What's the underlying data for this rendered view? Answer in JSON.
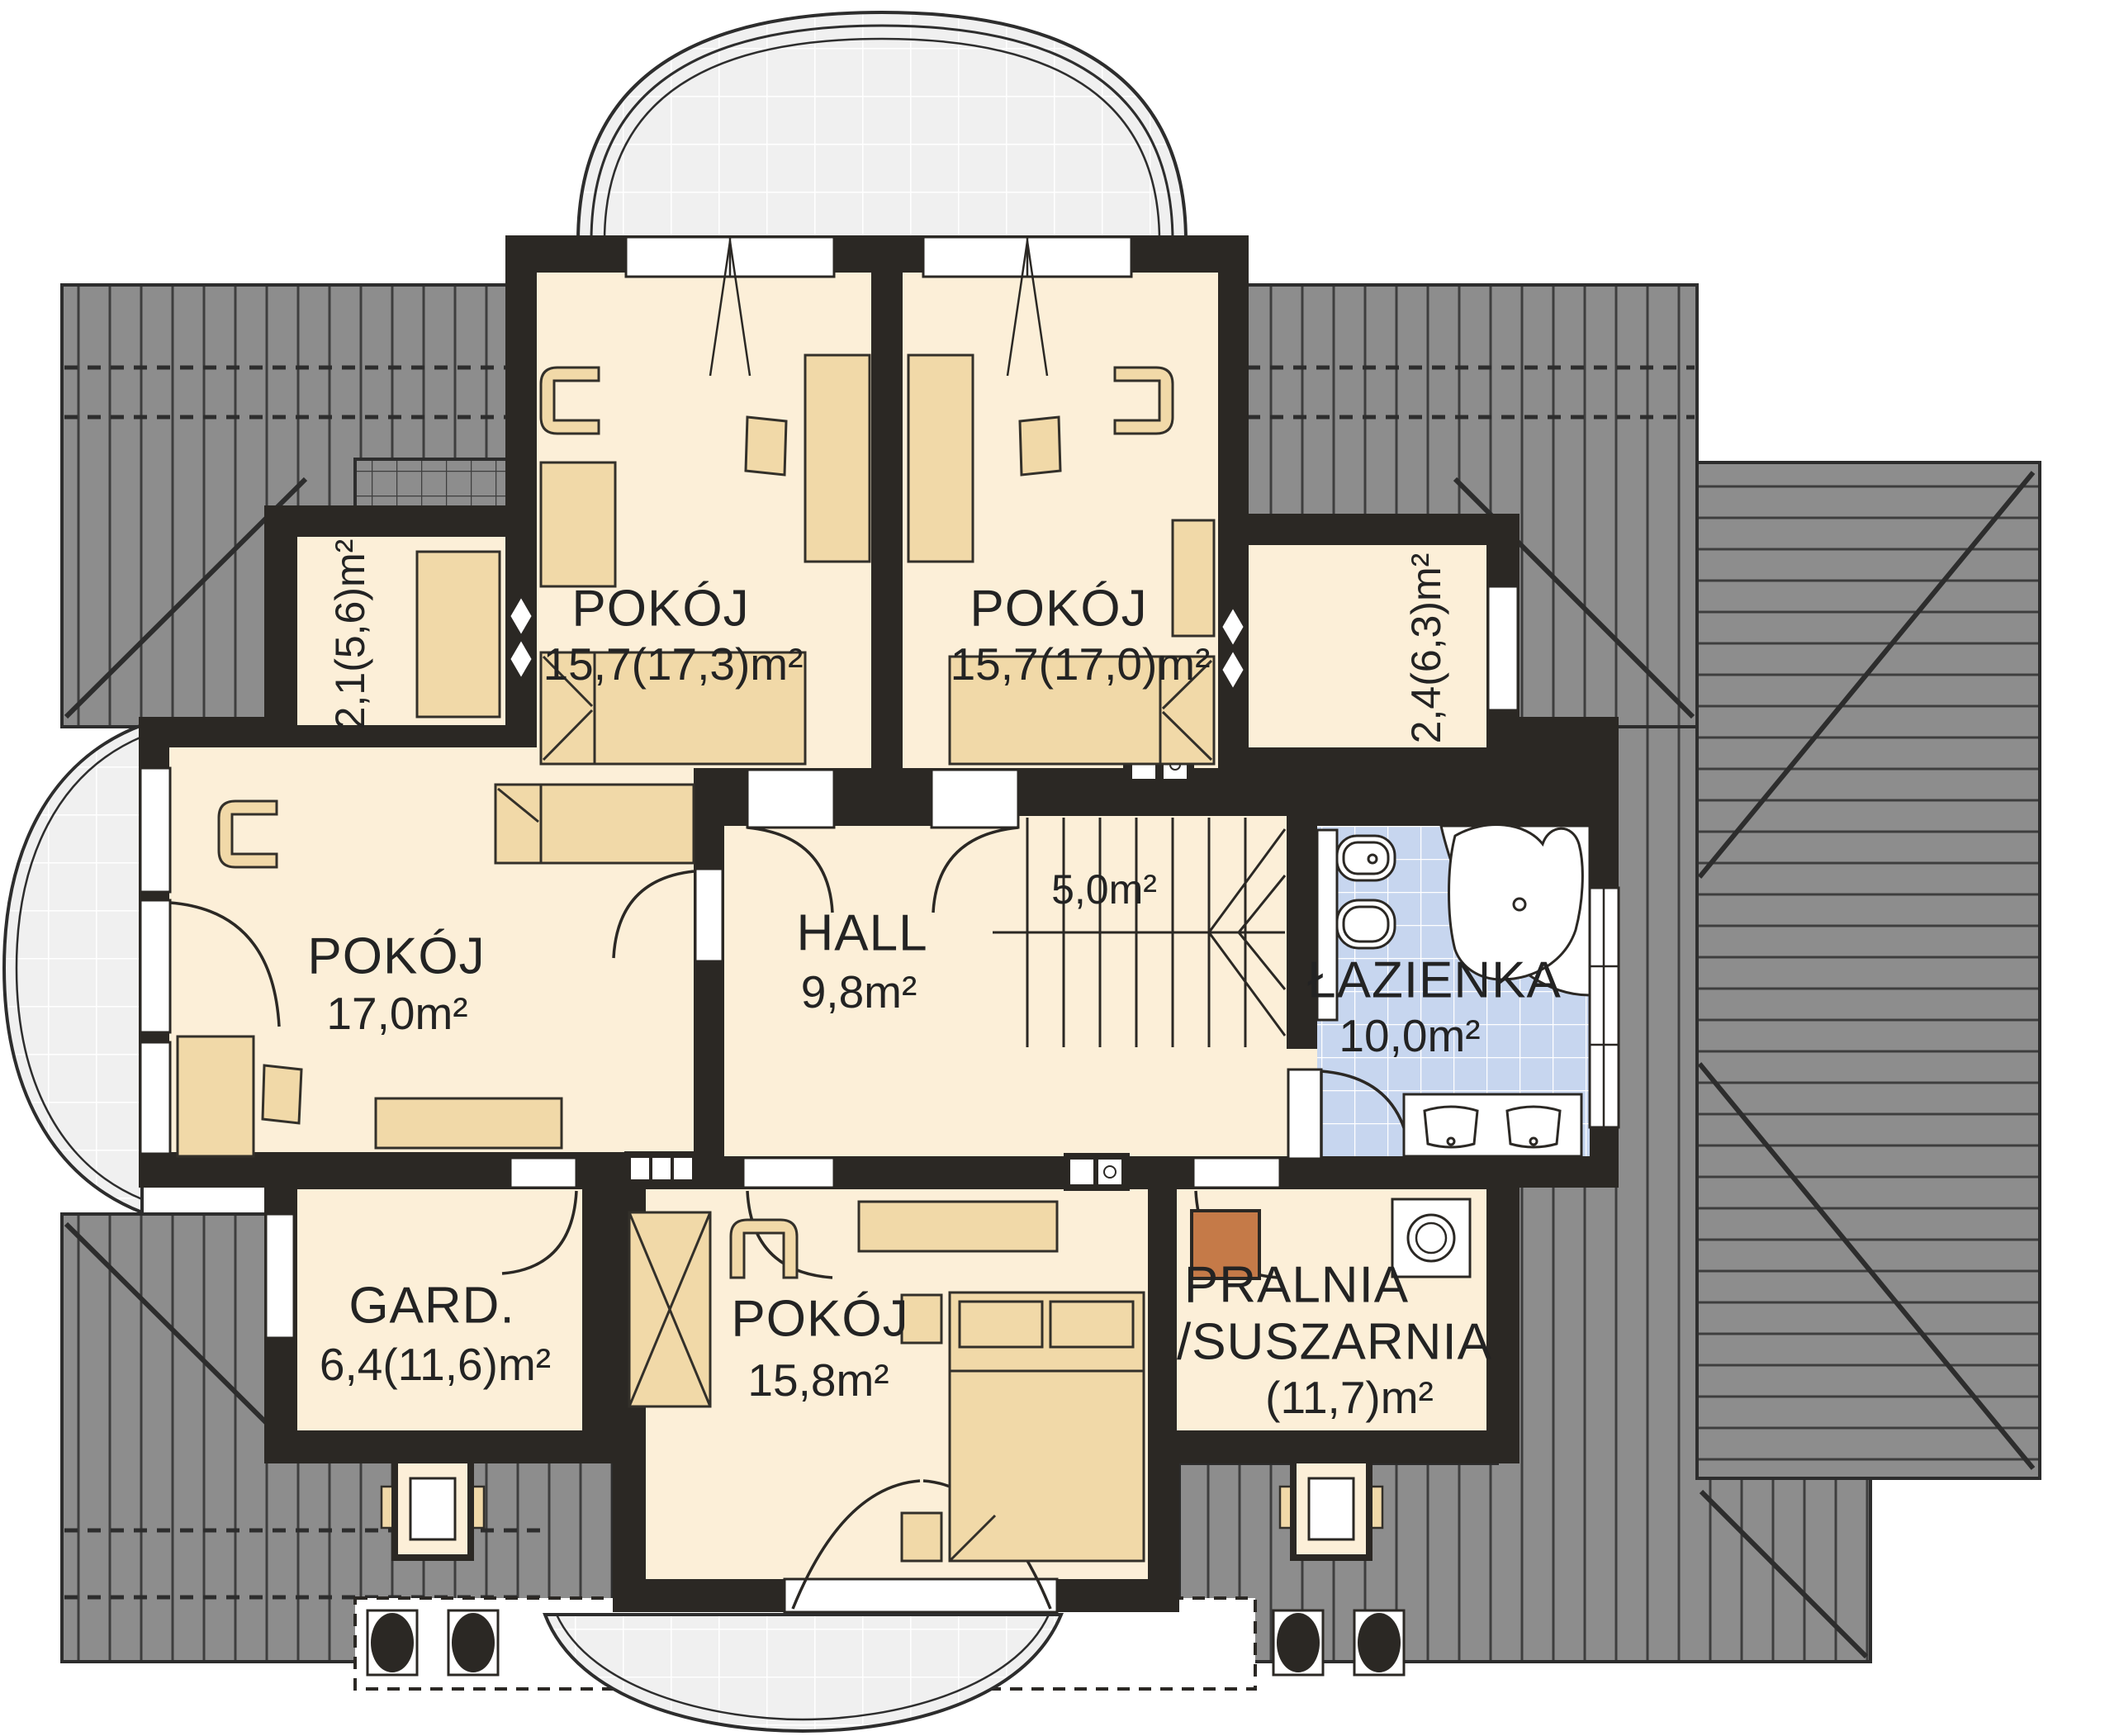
{
  "colors": {
    "wall": "#2b2824",
    "room": "#fcefd8",
    "furn": "#f1d9a8",
    "furnline": "#33302a",
    "roof": "#8d8d8d",
    "roofline": "#3e3e3e",
    "roofedge": "#2d2d2d",
    "tile": "#c7d6ef",
    "balcony": "#f0f0f0",
    "orange": "#c57a48",
    "text": "#232323"
  },
  "rooms": {
    "bedroom_top_left": {
      "name": "POKÓJ",
      "area": "15,7(17,3)m²"
    },
    "bedroom_top_right": {
      "name": "POKÓJ",
      "area": "15,7(17,0)m²"
    },
    "bedroom_left": {
      "name": "POKÓJ",
      "area": "17,0m²"
    },
    "bedroom_bottom": {
      "name": "POKÓJ",
      "area": "15,8m²"
    },
    "hall": {
      "name": "HALL",
      "area": "9,8m²"
    },
    "stairs": {
      "area": "5,0m²"
    },
    "bathroom": {
      "name": "ŁAZIENKA",
      "area": "10,0m²"
    },
    "wardrobe": {
      "name": "GARD.",
      "area": "6,4(11,6)m²"
    },
    "laundry": {
      "name_line1": "PRALNIA",
      "name_line2": "/SUSZARNIA",
      "area": "(11,7)m²"
    },
    "niche_left": {
      "area": "2,1(5,6)m²"
    },
    "niche_right": {
      "area": "2,4(6,3)m²"
    }
  }
}
